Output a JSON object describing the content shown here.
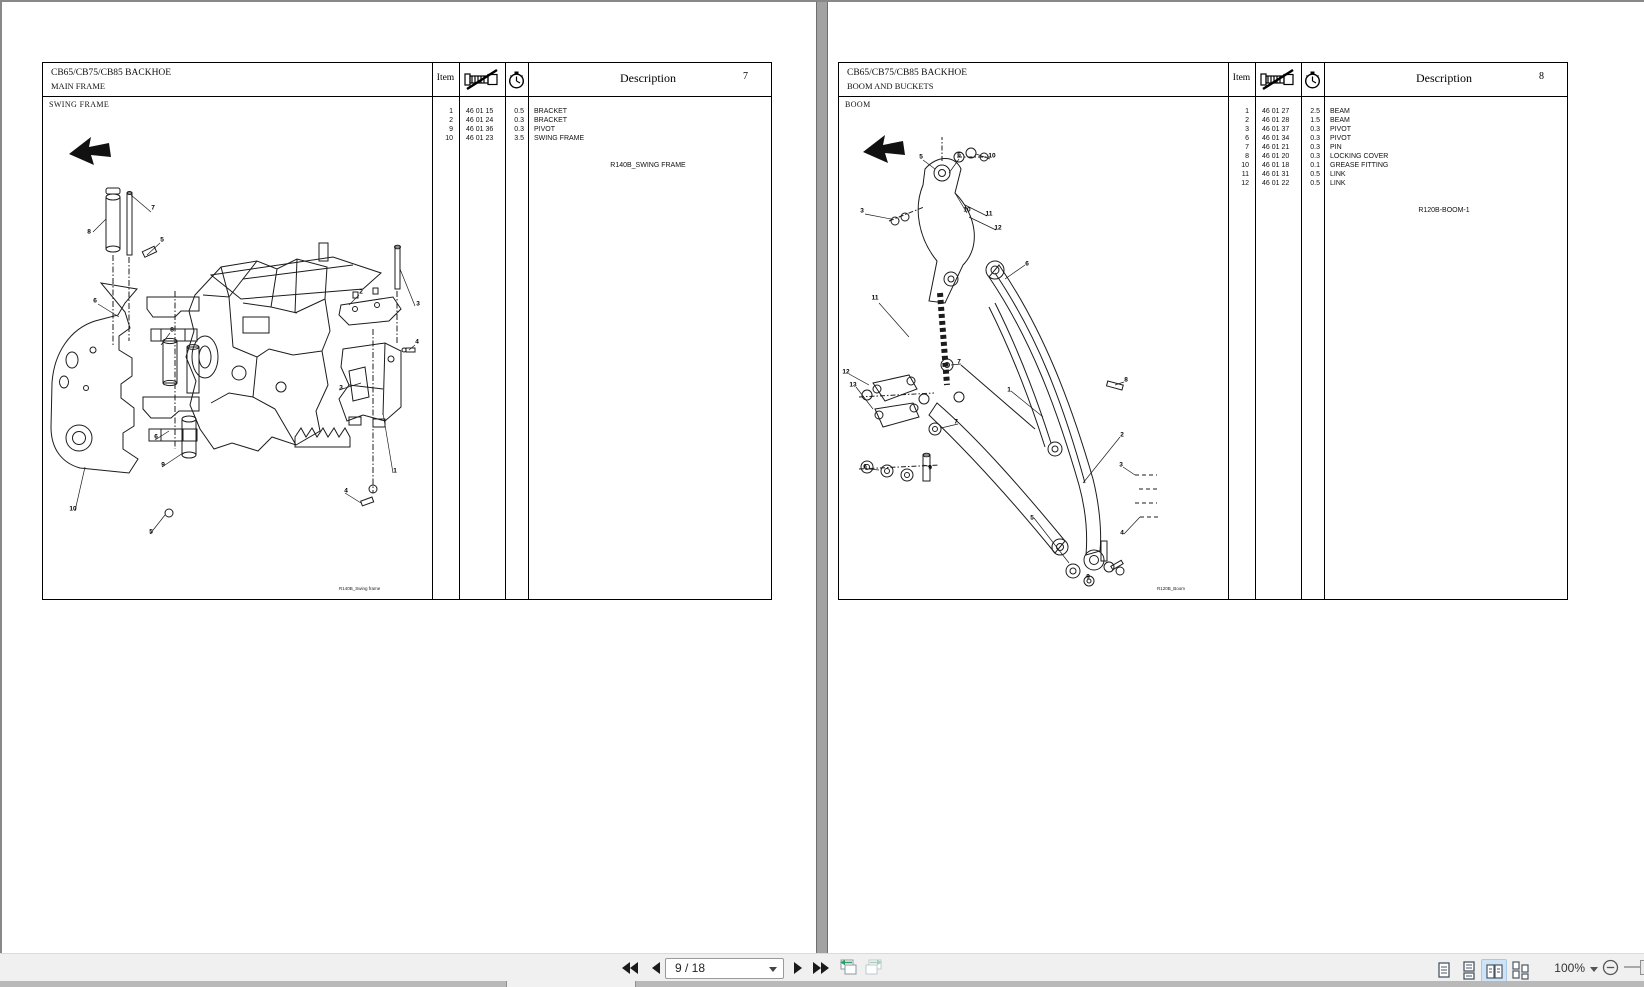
{
  "toolbar": {
    "page_field_value": "9 / 18",
    "zoom_value": "100%"
  },
  "colors": {
    "toolbar_bg": "#f0f0f0",
    "selected_view_bg": "#cfe3f6",
    "nav_arrow_green": "#2f9e62",
    "page_divider": "#a2a2a2"
  },
  "icons": {
    "first_page": "double-left-triangle",
    "previous_page": "left-triangle",
    "next_page": "right-triangle",
    "last_page": "double-right-triangle",
    "previous_view": "pages-with-green-left-arrow",
    "next_view": "pages-with-green-right-arrow",
    "single_page_view": "one-page",
    "continuous_view": "stacked-pages",
    "facing_view": "two-pages",
    "facing_continuous_view": "two-page-columns",
    "zoom_out": "circled-minus",
    "parts_column": "bolt-with-slash",
    "hours_column": "stopwatch",
    "travel_direction": "solid-left-arrow"
  },
  "pages": [
    {
      "title": "CB65/CB75/CB85 BACKHOE",
      "subtitle": "MAIN FRAME",
      "item_header": "Item",
      "description_header": "Description",
      "page_number": "7",
      "section": "SWING FRAME",
      "figure_ref": "R140B_SWING FRAME",
      "diagram_caption": "R140B_Swing frame",
      "rows": [
        {
          "item": "1",
          "part": "46 01 15",
          "hrs": "0.5",
          "desc": "BRACKET"
        },
        {
          "item": "2",
          "part": "46 01 24",
          "hrs": "0.3",
          "desc": "BRACKET"
        },
        {
          "item": "9",
          "part": "46 01 36",
          "hrs": "0.3",
          "desc": "PIVOT"
        },
        {
          "item": "10",
          "part": "46 01 23",
          "hrs": "3.5",
          "desc": "SWING FRAME"
        }
      ],
      "callouts": [
        {
          "t": "7",
          "x": 110,
          "y": 111
        },
        {
          "t": "8",
          "x": 46,
          "y": 135
        },
        {
          "t": "5",
          "x": 119,
          "y": 143
        },
        {
          "t": "6",
          "x": 52,
          "y": 204
        },
        {
          "t": "8",
          "x": 129,
          "y": 233
        },
        {
          "t": "2",
          "x": 318,
          "y": 195
        },
        {
          "t": "3",
          "x": 375,
          "y": 207
        },
        {
          "t": "4",
          "x": 374,
          "y": 245
        },
        {
          "t": "3",
          "x": 298,
          "y": 291
        },
        {
          "t": "6",
          "x": 113,
          "y": 340
        },
        {
          "t": "9",
          "x": 120,
          "y": 368
        },
        {
          "t": "1",
          "x": 352,
          "y": 374
        },
        {
          "t": "4",
          "x": 303,
          "y": 394
        },
        {
          "t": "10",
          "x": 30,
          "y": 412
        },
        {
          "t": "5",
          "x": 108,
          "y": 435
        }
      ]
    },
    {
      "title": "CB65/CB75/CB85 BACKHOE",
      "subtitle": "BOOM AND BUCKETS",
      "item_header": "Item",
      "description_header": "Description",
      "page_number": "8",
      "section": "BOOM",
      "figure_ref": "R120B-BOOM-1",
      "diagram_caption": "R120B_Boom",
      "rows": [
        {
          "item": "1",
          "part": "46 01 27",
          "hrs": "2.5",
          "desc": "BEAM"
        },
        {
          "item": "2",
          "part": "46 01 28",
          "hrs": "1.5",
          "desc": "BEAM"
        },
        {
          "item": "3",
          "part": "46 01 37",
          "hrs": "0.3",
          "desc": "PIVOT"
        },
        {
          "item": "6",
          "part": "46 01 34",
          "hrs": "0.3",
          "desc": "PIVOT"
        },
        {
          "item": "7",
          "part": "46 01 21",
          "hrs": "0.3",
          "desc": "PIN"
        },
        {
          "item": "8",
          "part": "46 01 20",
          "hrs": "0.3",
          "desc": "LOCKING COVER"
        },
        {
          "item": "10",
          "part": "46 01 18",
          "hrs": "0.1",
          "desc": "GREASE FITTING"
        },
        {
          "item": "11",
          "part": "46 01 31",
          "hrs": "0.5",
          "desc": "LINK"
        },
        {
          "item": "12",
          "part": "46 01 22",
          "hrs": "0.5",
          "desc": "LINK"
        }
      ],
      "callouts": [
        {
          "t": "5",
          "x": 82,
          "y": 60
        },
        {
          "t": "6",
          "x": 120,
          "y": 58
        },
        {
          "t": "10",
          "x": 153,
          "y": 59
        },
        {
          "t": "3",
          "x": 23,
          "y": 114
        },
        {
          "t": "10",
          "x": 128,
          "y": 113
        },
        {
          "t": "11",
          "x": 150,
          "y": 117
        },
        {
          "t": "12",
          "x": 159,
          "y": 131
        },
        {
          "t": "6",
          "x": 188,
          "y": 167
        },
        {
          "t": "11",
          "x": 36,
          "y": 201
        },
        {
          "t": "12",
          "x": 7,
          "y": 275
        },
        {
          "t": "13",
          "x": 14,
          "y": 288
        },
        {
          "t": "7",
          "x": 120,
          "y": 265
        },
        {
          "t": "7",
          "x": 117,
          "y": 325
        },
        {
          "t": "1",
          "x": 170,
          "y": 293
        },
        {
          "t": "8",
          "x": 287,
          "y": 283
        },
        {
          "t": "2",
          "x": 283,
          "y": 338
        },
        {
          "t": "6",
          "x": 26,
          "y": 370
        },
        {
          "t": "9",
          "x": 91,
          "y": 371
        },
        {
          "t": "3",
          "x": 282,
          "y": 368
        },
        {
          "t": "4",
          "x": 283,
          "y": 436
        },
        {
          "t": "5",
          "x": 193,
          "y": 421
        },
        {
          "t": "9",
          "x": 249,
          "y": 480
        }
      ]
    }
  ]
}
